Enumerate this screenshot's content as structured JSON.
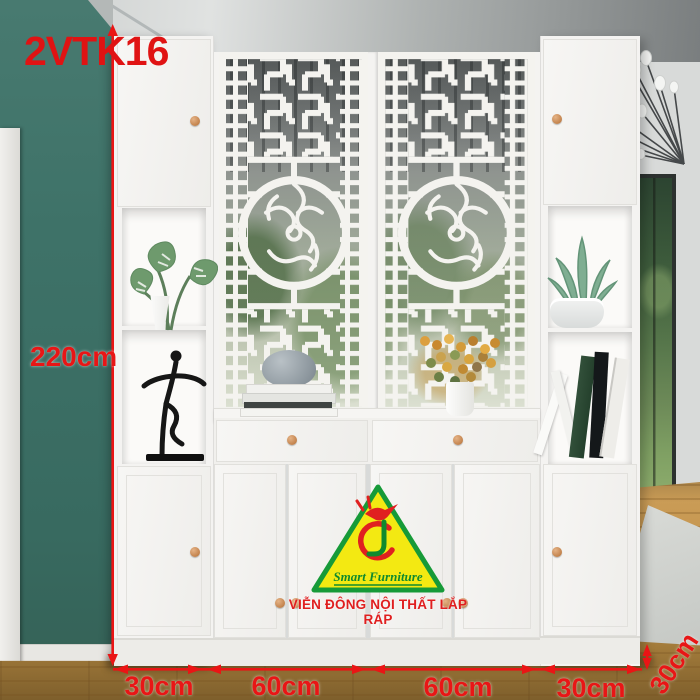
{
  "product_code": "2VTK16",
  "annotations": {
    "height": "220cm",
    "width_segments": [
      "30cm",
      "60cm",
      "60cm",
      "30cm"
    ],
    "depth": "30cm"
  },
  "logo": {
    "brand": "Smart Furniture",
    "tagline": "VIỄN ĐÔNG NỘI THẤT LẮP RÁP"
  },
  "colors": {
    "annotation_red": "#e51717",
    "accent_wall_teal": "#3e7268",
    "cabinet_white": "#f4f3f1",
    "logo_yellow": "#f3e912",
    "logo_green": "#169a38",
    "logo_red": "#e02020",
    "knob_tan": "#cf9a63",
    "floor_wood": "#c2924c"
  }
}
